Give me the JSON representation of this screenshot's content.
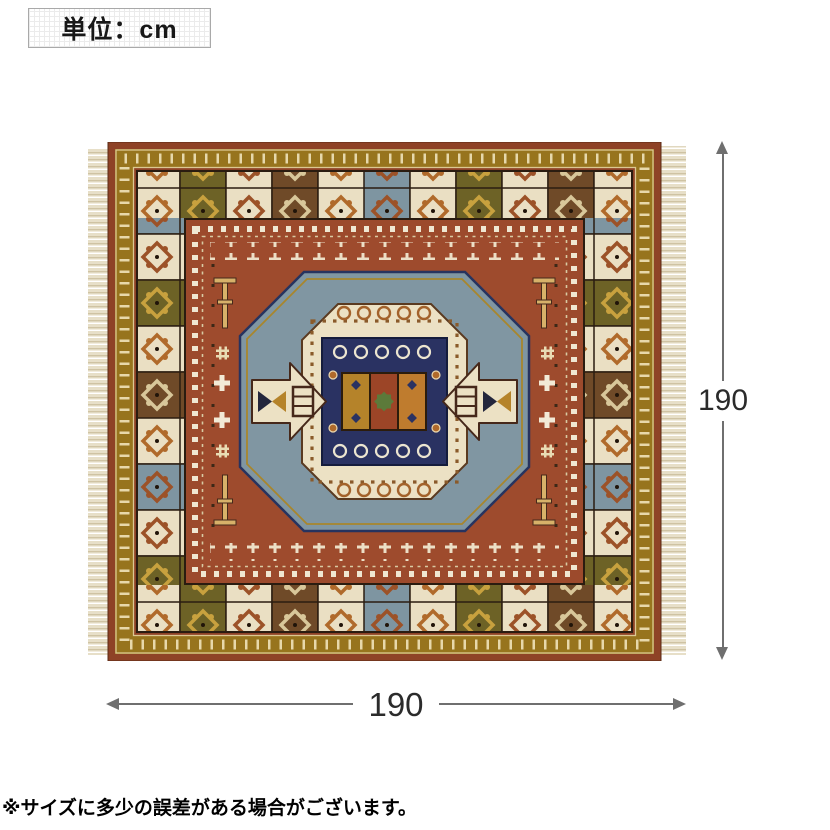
{
  "unit_box": {
    "label": "単位：cm"
  },
  "dimensions": {
    "height_label": "190",
    "width_label": "190",
    "unit": "cm"
  },
  "note": {
    "text": "※サイズに多少の誤差がある場合がございます。"
  },
  "rug": {
    "description": "red kazak-style patterned rug with ivory fringe on left and right edges",
    "colors": {
      "field_red": "#9e4b2d",
      "edge_red": "#8e4226",
      "border_gold": "#97741d",
      "slate_blue": "#8096a2",
      "ivory": "#ece1c4",
      "navy": "#2a3262",
      "orange": "#b06a2b",
      "olive": "#6d6226",
      "brown": "#6f4a28",
      "green_star": "#5c7a3a",
      "fringe": "#e7dfc8"
    }
  },
  "dimension_style": {
    "line_color": "#6f6f6f",
    "text_color": "#2b2b2b"
  }
}
